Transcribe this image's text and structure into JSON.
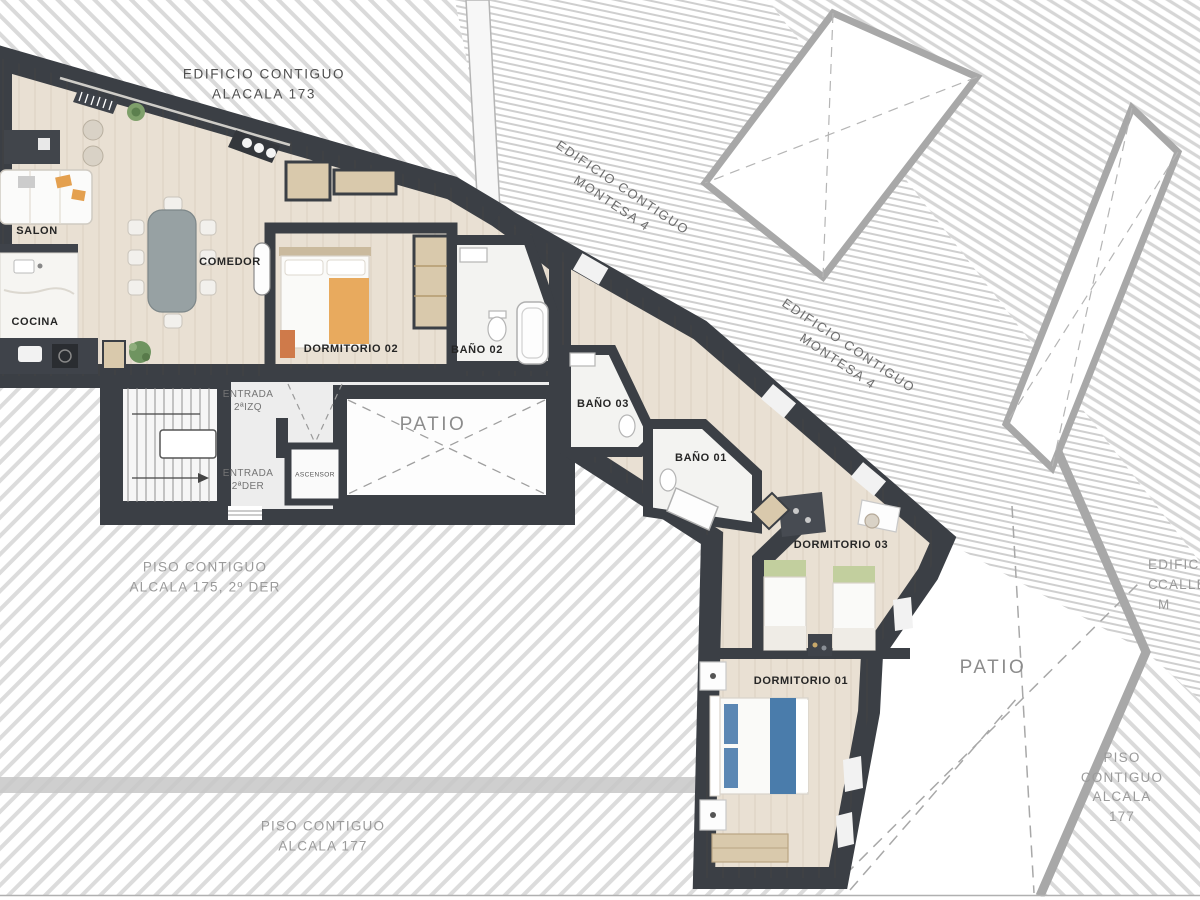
{
  "labels": {
    "alcala173": "EDIFICIO CONTIGUO\nALACALA 173",
    "montesa_top": "EDIFICIO CONTIGUO\nMONTESA  4",
    "montesa_mid": "EDIFICIO CONTIGUO\nMONTESA  4",
    "calle_montesa_line1": "EDIFICIO C",
    "calle_montesa_line2": "CALLE M",
    "piso175": "PISO CONTIGUO\nALCALA 175, 2º DER",
    "piso177_bottom": "PISO CONTIGUO\nALCALA 177",
    "piso177_right": "PISO CONTIGUO\nALCALA 177",
    "salon": "SALON",
    "cocina": "COCINA",
    "comedor": "COMEDOR",
    "dormitorio02": "DORMITORIO 02",
    "bano02": "BAÑO 02",
    "bano03": "BAÑO 03",
    "bano01": "BAÑO 01",
    "dormitorio03": "DORMITORIO 03",
    "dormitorio01": "DORMITORIO 01",
    "patio_left": "PATIO",
    "patio_right": "PATIO",
    "entrada_izq": "ENTRADA\n2ªIZQ",
    "entrada_der": "ENTRADA\n2ªDER",
    "ascensor": "ASCENSOR"
  },
  "colors": {
    "wall": "#3b3f45",
    "floor": "#e9e0d3",
    "bath_floor": "#f3f3f1",
    "hatch_line": "#d9d9d9",
    "neighbor_wall": "#a8a8a8",
    "patio": "#ffffff",
    "wood": "#d9c9ac",
    "table_gray": "#97a1a3",
    "bed_orange": "#e8aa5e",
    "bed_blue": "#4a7cab",
    "bed_green": "#c2cf9e",
    "text_dark": "#262626",
    "text_gray": "#9b9b9b"
  }
}
